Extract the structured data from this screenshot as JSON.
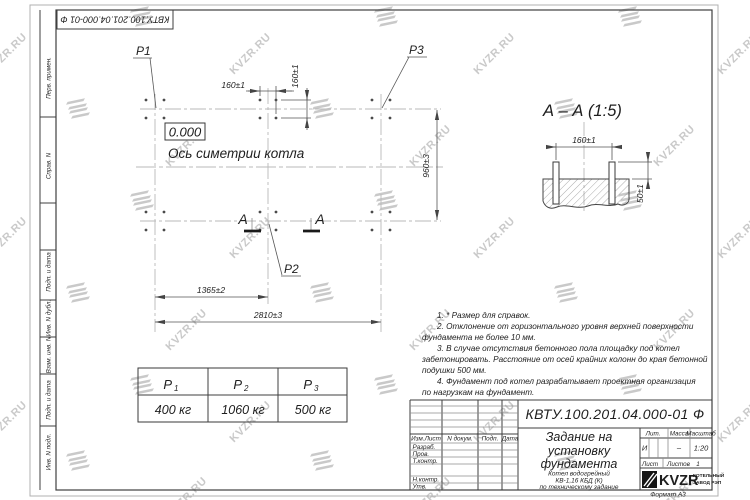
{
  "watermark": {
    "text": "KVZR.RU"
  },
  "frame": {
    "top_designation": "КВТУ.100.201.04.000-01 Ф",
    "format_label": "Формат А3",
    "side_labels": [
      "Перв. примен.",
      "Справ. N",
      "Подп. и дата",
      "Инв. N дубл.",
      "Взам. инв. N",
      "Подп. и дата",
      "Инв. N подл."
    ]
  },
  "plan": {
    "elevation_mark": "0.000",
    "symmetry_axis_label": "Ось симетрии котла",
    "load_labels": {
      "p1": "P1",
      "p2": "P2",
      "p3": "P3"
    },
    "section_letter_left": "А",
    "section_letter_right": "А",
    "dim_160_top": "160±1",
    "dim_160_side": "160±1",
    "dim_960": "960±3",
    "dim_1365": "1365±2",
    "dim_2810": "2810±3"
  },
  "section_view": {
    "title": "А – А (1:5)",
    "dim_160": "160±1",
    "dim_50": "50±1"
  },
  "loads_table": {
    "headers": [
      {
        "base": "P",
        "sub": "1"
      },
      {
        "base": "P",
        "sub": "2"
      },
      {
        "base": "P",
        "sub": "3"
      }
    ],
    "values": [
      "400 кг",
      "1060 кг",
      "500 кг"
    ]
  },
  "notes": {
    "lines": [
      "1. * Размер для справок.",
      "2. Отклонение от горизонтального уровня верхней поверхности",
      "фундамента не более 10 мм.",
      "3. В случае отсутствия бетонного пола площадку под котел",
      "забетонировать. Расстояние от осей крайних колонн до края бетонной",
      "подушки 500 мм.",
      "4. Фундамент под котел разрабатывает проектная организация",
      "по нагрузкам на фундамент."
    ]
  },
  "title_block": {
    "designation": "КВТУ.100.201.04.000-01 Ф",
    "doc_title_lines": [
      "Задание на",
      "установку",
      "фундамента"
    ],
    "product_lines": [
      "Котел водогрейный",
      "КВ-1,16 КБД (К)",
      "по техническому задание"
    ],
    "header_cells": [
      "Изм.Лист",
      "N докум.",
      "Подп.",
      "Дата"
    ],
    "row_labels": [
      "Разраб.",
      "Пров.",
      "Т.контр.",
      "Н.контр.",
      "Утв."
    ],
    "lit_label": "Лит.",
    "mass_label": "Масса",
    "scale_label": "Масштаб",
    "lit_value": "И",
    "mass_value": "–",
    "scale_value": "1:20",
    "sheet_label": "Лист",
    "sheets_label": "Листов",
    "sheets_value": "1",
    "logo_text": "KVZR",
    "logo_caption_lines": [
      "КОТЕЛЬНЫЙ",
      "ЗАВОД РЭП"
    ]
  }
}
